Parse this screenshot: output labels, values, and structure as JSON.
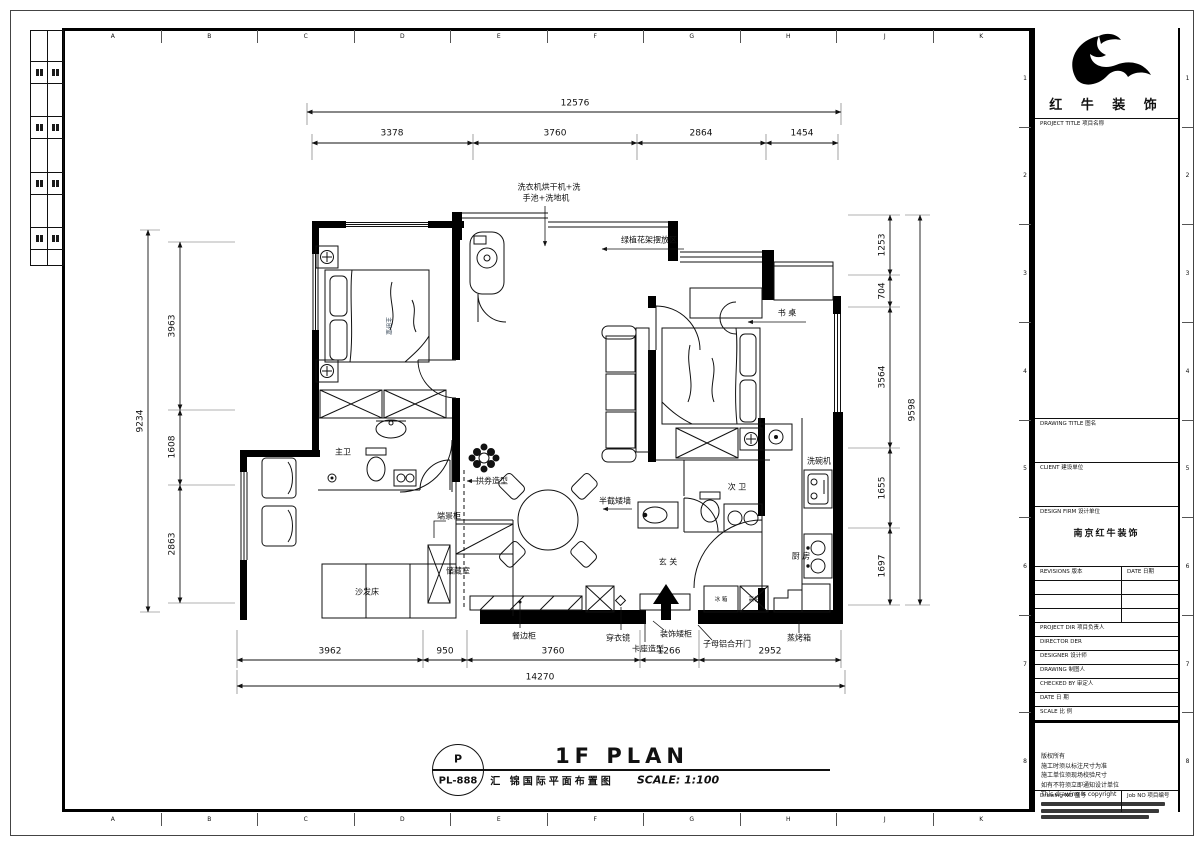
{
  "sheet": {
    "grid_letters": [
      "A",
      "B",
      "C",
      "D",
      "E",
      "F",
      "G",
      "H",
      "J",
      "K"
    ],
    "grid_numbers": [
      "1",
      "2",
      "3",
      "4",
      "5",
      "6",
      "7",
      "8"
    ]
  },
  "title_block": {
    "company_name": "红 牛 装 饰",
    "project_title_label": "PROJECT TITLE 项目名称",
    "drawing_title_label": "DRAWING TITLE 图名",
    "client_label": "CLIENT 建设单位",
    "design_firm_label": "DESIGN FIRM 设计单位",
    "design_firm_value": "南京红牛装饰",
    "revisions_label": "REVISIONS 版本",
    "revisions_date_label": "DATE 日期",
    "project_dir_label": "PROJECT DIR 项目负责人",
    "director_label": "DIRECTOR DER",
    "designer_label": "DESIGNER 设计师",
    "drawing_by_label": "DRAWING 制图人",
    "checked_by_label": "CHECKED BY 审定人",
    "date_label": "DATE 日 期",
    "scale_label": "SCALE 比 例",
    "notes": [
      "版权所有",
      "施工时须以标注尺寸为准",
      "施工单位须现场校验尺寸",
      "如有不符须立即通知设计单位",
      "This drawing is copyright"
    ],
    "drawing_no_label": "Drawing NO 图号",
    "job_no_label": "Job NO 项目编号"
  },
  "footer": {
    "bubble_top": "P",
    "bubble_bottom": "PL-888",
    "title_en": "1F PLAN",
    "title_cn": "汇 锦国际平面布置图",
    "scale_text": "SCALE: 1:100"
  },
  "dimensions": {
    "top": {
      "overall": "12576",
      "segments": [
        "3378",
        "3760",
        "2864",
        "1454"
      ]
    },
    "bottom": {
      "overall": "14270",
      "segments": [
        "3962",
        "950",
        "3760",
        "1266",
        "2952"
      ]
    },
    "left": {
      "overall": "9234",
      "segments": [
        "3963",
        "1608",
        "2863"
      ]
    },
    "right": {
      "overall": "9598",
      "segments": [
        "1253",
        "704",
        "3564",
        "1655",
        "1697"
      ]
    }
  },
  "plan": {
    "labels": {
      "laundry_line1": "洗衣机烘干机+洗",
      "laundry_line2": "手池+洗地机",
      "plant_rack_area": "绿植花架摆放区",
      "desk": "书 桌",
      "master_bath": "主卫",
      "second_bath": "次 卫",
      "kitchen": "厨 房",
      "entry": "玄 关",
      "dishwasher": "洗碗机",
      "half_wall": "半截矮墙",
      "arch_feature": "拱券造型",
      "end_view_cabinet": "端景柜",
      "storage_room": "储藏室",
      "sofa_bed": "沙发床",
      "sideboard": "餐边柜",
      "dressing_mirror": "穿衣镜",
      "bench_feature": "卡座造型",
      "deco_low_cabinet": "装饰矮柜",
      "entry_door": "子母铝合开门",
      "steam_oven": "蒸烤箱",
      "fridge": "冰 箱",
      "tall_cabinet": "高柜",
      "master_bedroom_tag": "主卧室"
    }
  }
}
